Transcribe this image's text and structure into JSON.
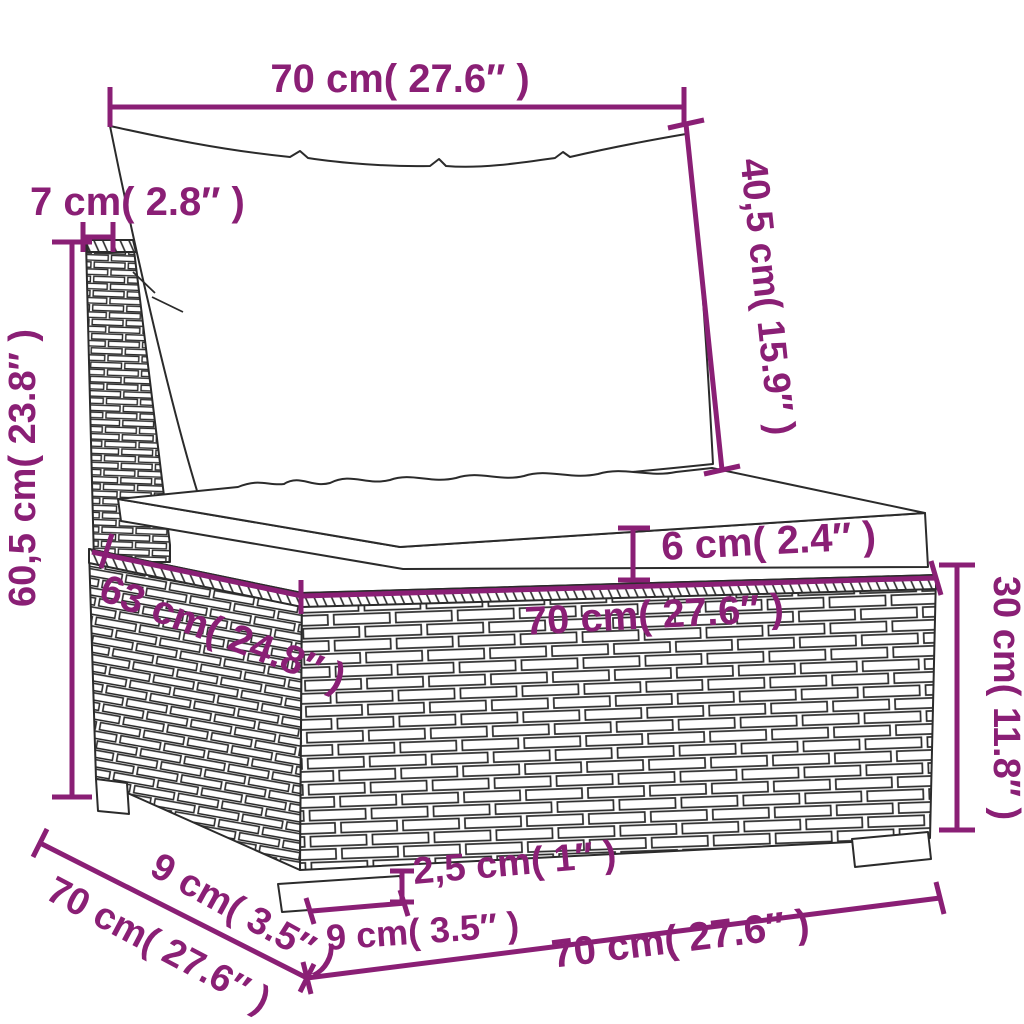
{
  "diagram": {
    "kind": "product-dimension-diagram",
    "subject": "poly rattan garden sofa middle section with cushions",
    "accent_color": "#8a1f75",
    "outline_color": "#2b2b2b",
    "background_color": "#ffffff",
    "dimensions": {
      "back_cushion_width": "70 cm( 27.6″ )",
      "back_post_width": "7 cm( 2.8″ )",
      "back_cushion_height": "40,5 cm( 15.9″ )",
      "back_total_height": "60,5 cm( 23.8″ )",
      "seat_cushion_thickness": "6 cm( 2.4″ )",
      "seat_depth": "63 cm( 24.8″ )",
      "seat_width": "70 cm( 27.6″ )",
      "base_height": "30 cm( 11.8″ )",
      "leg_depth": "9 cm( 3.5″ )",
      "base_depth": "70 cm( 27.6″ )",
      "leg_height": "2,5 cm( 1″ )",
      "leg_width": "9 cm( 3.5″ )",
      "base_width": "70 cm( 27.6″ )"
    }
  }
}
